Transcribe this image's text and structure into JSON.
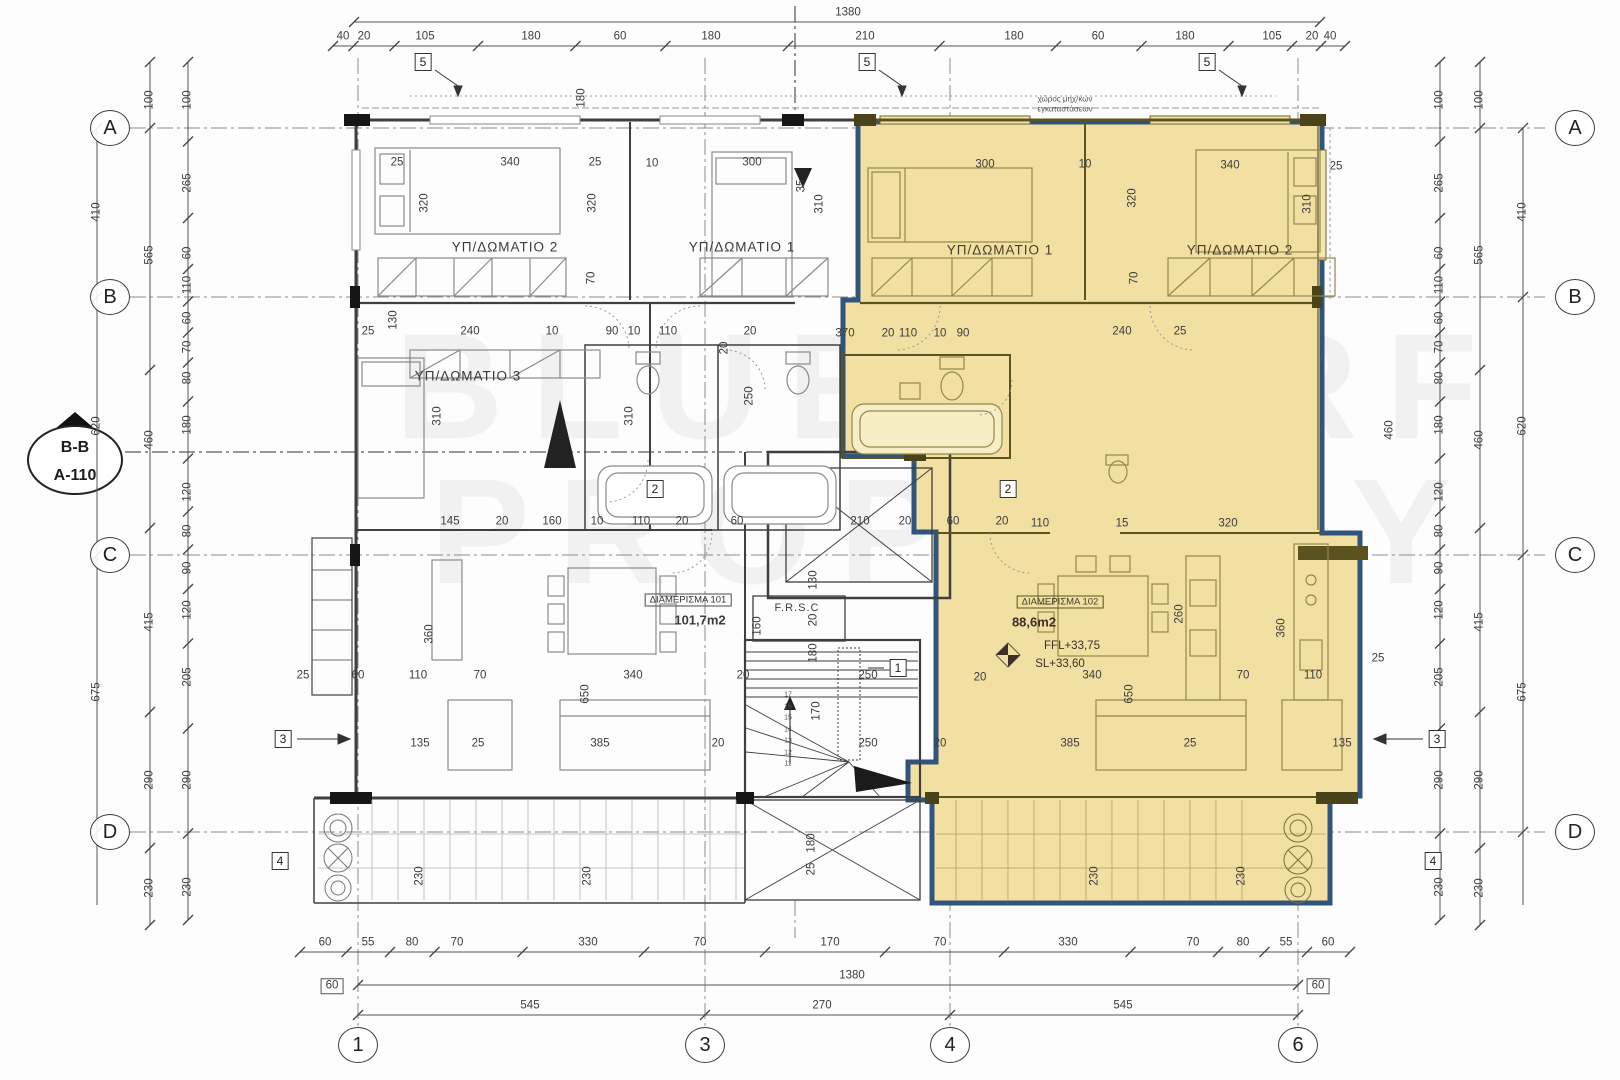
{
  "title": "Floor plan",
  "watermark": {
    "line1": "BLUE SURF",
    "line2": "PROPERTY"
  },
  "colors": {
    "highlight": "#f2dfa2",
    "highlight_border": "#31547c",
    "wall_dark": "#3f3f3f",
    "wall_olive": "#5c541f",
    "grid_line": "#8a8a8a",
    "dim_text": "#3d3d3d"
  },
  "section_marker": {
    "top": "B-B",
    "bottom": "A-110"
  },
  "notes": {
    "top_center_1": "χώρος μηχ/κων",
    "top_center_2": "εγκαταστάσεων",
    "frsc": "F.R.S.C"
  },
  "apartments": [
    {
      "name": "ΔΙΑΜΕΡΙΣΜΑ 101",
      "area": "101,7m2"
    },
    {
      "name": "ΔΙΑΜΕΡΙΣΜΑ 102",
      "area": "88,6m2",
      "ffl": "FFL+33,75",
      "sl": "SL+33,60"
    }
  ],
  "rooms": {
    "left_bed2": "ΥΠ/ΔΩΜΑΤΙΟ 2",
    "left_bed1": "ΥΠ/ΔΩΜΑΤΙΟ 1",
    "left_bed3": "ΥΠ/ΔΩΜΑΤΙΟ 3",
    "right_bed1": "ΥΠ/ΔΩΜΑΤΙΟ 1",
    "right_bed2": "ΥΠ/ΔΩΜΑΤΙΟ 2"
  },
  "grid": {
    "bubble_left_x": 110,
    "bubble_right_x": 1575,
    "bubble_bottom_y": 1045,
    "rows": [
      {
        "label": "A",
        "y": 128
      },
      {
        "label": "B",
        "y": 297
      },
      {
        "label": "C",
        "y": 555
      },
      {
        "label": "D",
        "y": 832
      }
    ],
    "cols": [
      {
        "label": "1",
        "x": 358
      },
      {
        "label": "3",
        "x": 705
      },
      {
        "label": "4",
        "x": 950
      },
      {
        "label": "6",
        "x": 1298
      }
    ]
  },
  "detail_markers": [
    {
      "label": "5",
      "x": 423,
      "y": 62
    },
    {
      "label": "5",
      "x": 867,
      "y": 62
    },
    {
      "label": "5",
      "x": 1207,
      "y": 62
    },
    {
      "label": "2",
      "x": 655,
      "y": 489
    },
    {
      "label": "2",
      "x": 1008,
      "y": 489
    },
    {
      "label": "1",
      "x": 898,
      "y": 668
    },
    {
      "label": "3",
      "x": 283,
      "y": 739
    },
    {
      "label": "3",
      "x": 1437,
      "y": 739
    },
    {
      "label": "4",
      "x": 280,
      "y": 861
    },
    {
      "label": "4",
      "x": 1433,
      "y": 861
    }
  ],
  "stair": {
    "steps": [
      "17",
      "16",
      "15",
      "14",
      "13",
      "12",
      "11"
    ],
    "x": 788,
    "y0": 695,
    "dy": 11.5
  },
  "dims": {
    "rows": [
      {
        "y": 22,
        "x1": 354,
        "x2": 1320,
        "ticks": [
          354,
          1320
        ],
        "labels": [
          [
            "1380",
            848
          ]
        ]
      },
      {
        "y": 46,
        "x1": 333,
        "x2": 1345,
        "labels": [
          [
            "40",
            343
          ],
          [
            "20",
            364
          ],
          [
            "105",
            425
          ],
          [
            "180",
            531
          ],
          [
            "60",
            620
          ],
          [
            "180",
            711
          ],
          [
            "210",
            865
          ],
          [
            "180",
            1014
          ],
          [
            "60",
            1098
          ],
          [
            "180",
            1185
          ],
          [
            "105",
            1272
          ],
          [
            "20",
            1312
          ],
          [
            "40",
            1330
          ]
        ]
      },
      {
        "y": 952,
        "x1": 300,
        "x2": 1350,
        "labels": [
          [
            "60",
            325
          ],
          [
            "55",
            368
          ],
          [
            "80",
            412
          ],
          [
            "70",
            457
          ],
          [
            "330",
            588
          ],
          [
            "70",
            700
          ],
          [
            "170",
            830
          ],
          [
            "70",
            940
          ],
          [
            "330",
            1068
          ],
          [
            "70",
            1193
          ],
          [
            "80",
            1243
          ],
          [
            "55",
            1286
          ],
          [
            "60",
            1328
          ]
        ]
      },
      {
        "y": 985,
        "x1": 358,
        "x2": 1298,
        "ticks": [
          358,
          1298
        ],
        "labels": [
          [
            "1380",
            852
          ]
        ]
      },
      {
        "y": 1015,
        "x1": 358,
        "x2": 1298,
        "ticks": [
          358,
          705,
          950,
          1298
        ],
        "labels": [
          [
            "545",
            530
          ],
          [
            "270",
            822
          ],
          [
            "545",
            1123
          ]
        ]
      }
    ],
    "cols": [
      {
        "x": 97,
        "y1": 128,
        "y2": 905,
        "ticks": [
          128,
          297,
          555,
          832
        ],
        "labels": [
          [
            "410",
            212
          ],
          [
            "620",
            426
          ],
          [
            "675",
            692
          ]
        ]
      },
      {
        "x": 150,
        "y1": 62,
        "y2": 925,
        "ticks": [
          62,
          128,
          370,
          528,
          712,
          848,
          925
        ],
        "labels": [
          [
            "100",
            100
          ],
          [
            "565",
            255
          ],
          [
            "460",
            440
          ],
          [
            "415",
            622
          ],
          [
            "290",
            780
          ],
          [
            "230",
            888
          ]
        ]
      },
      {
        "x": 188,
        "y1": 62,
        "y2": 920,
        "labels": [
          [
            "100",
            100
          ],
          [
            "265",
            183
          ],
          [
            "60",
            253
          ],
          [
            "110",
            285
          ],
          [
            "60",
            318
          ],
          [
            "70",
            347
          ],
          [
            "80",
            378
          ],
          [
            "180",
            425
          ],
          [
            "120",
            492
          ],
          [
            "80",
            531
          ],
          [
            "90",
            568
          ],
          [
            "120",
            610
          ],
          [
            "205",
            677
          ],
          [
            "290",
            780
          ],
          [
            "230",
            887
          ]
        ]
      },
      {
        "x": 1523,
        "y1": 128,
        "y2": 905,
        "ticks": [
          128,
          297,
          555,
          832
        ],
        "labels": [
          [
            "410",
            212
          ],
          [
            "620",
            426
          ],
          [
            "675",
            692
          ]
        ]
      },
      {
        "x": 1480,
        "y1": 62,
        "y2": 925,
        "ticks": [
          62,
          128,
          370,
          528,
          712,
          848,
          925
        ],
        "labels": [
          [
            "100",
            100
          ],
          [
            "565",
            255
          ],
          [
            "460",
            440
          ],
          [
            "415",
            622
          ],
          [
            "290",
            780
          ],
          [
            "230",
            888
          ]
        ]
      },
      {
        "x": 1440,
        "y1": 62,
        "y2": 920,
        "labels": [
          [
            "100",
            100
          ],
          [
            "265",
            183
          ],
          [
            "60",
            253
          ],
          [
            "110",
            285
          ],
          [
            "60",
            318
          ],
          [
            "70",
            347
          ],
          [
            "80",
            378
          ],
          [
            "180",
            425
          ],
          [
            "120",
            492
          ],
          [
            "80",
            531
          ],
          [
            "90",
            568
          ],
          [
            "120",
            610
          ],
          [
            "205",
            677
          ],
          [
            "290",
            780
          ],
          [
            "230",
            887
          ]
        ]
      }
    ],
    "free": [
      [
        "25",
        397,
        163,
        0
      ],
      [
        "340",
        510,
        163,
        0
      ],
      [
        "25",
        595,
        163,
        0
      ],
      [
        "10",
        652,
        164,
        0
      ],
      [
        "300",
        752,
        163,
        0
      ],
      [
        "35",
        802,
        186,
        1
      ],
      [
        "300",
        985,
        165,
        0
      ],
      [
        "10",
        1085,
        165,
        0
      ],
      [
        "340",
        1230,
        166,
        0
      ],
      [
        "25",
        1336,
        167,
        0
      ],
      [
        "320",
        425,
        203,
        1
      ],
      [
        "320",
        593,
        203,
        1
      ],
      [
        "310",
        820,
        204,
        1
      ],
      [
        "320",
        1133,
        198,
        1
      ],
      [
        "310",
        1308,
        204,
        1
      ],
      [
        "180",
        582,
        98,
        1
      ],
      [
        "70",
        592,
        278,
        1
      ],
      [
        "70",
        1135,
        278,
        1
      ],
      [
        "25",
        368,
        332,
        0
      ],
      [
        "240",
        470,
        332,
        0
      ],
      [
        "10",
        552,
        332,
        0
      ],
      [
        "90",
        612,
        332,
        0
      ],
      [
        "10",
        634,
        332,
        0
      ],
      [
        "110",
        668,
        332,
        0
      ],
      [
        "20",
        750,
        332,
        0
      ],
      [
        "130",
        394,
        320,
        1
      ],
      [
        "370",
        845,
        334,
        0
      ],
      [
        "20",
        888,
        334,
        0
      ],
      [
        "110",
        908,
        334,
        0
      ],
      [
        "10",
        940,
        334,
        0
      ],
      [
        "90",
        963,
        334,
        0
      ],
      [
        "240",
        1122,
        332,
        0
      ],
      [
        "25",
        1180,
        332,
        0
      ],
      [
        "250",
        750,
        396,
        1
      ],
      [
        "20",
        725,
        348,
        1
      ],
      [
        "310",
        438,
        416,
        1
      ],
      [
        "310",
        630,
        416,
        1
      ],
      [
        "460",
        1390,
        430,
        1
      ],
      [
        "145",
        450,
        522,
        0
      ],
      [
        "20",
        502,
        522,
        0
      ],
      [
        "160",
        552,
        522,
        0
      ],
      [
        "10",
        597,
        522,
        0
      ],
      [
        "110",
        641,
        522,
        0
      ],
      [
        "20",
        682,
        522,
        0
      ],
      [
        "60",
        737,
        522,
        0
      ],
      [
        "210",
        860,
        522,
        0
      ],
      [
        "20",
        905,
        522,
        0
      ],
      [
        "60",
        953,
        522,
        0
      ],
      [
        "20",
        1002,
        522,
        0
      ],
      [
        "110",
        1040,
        524,
        0
      ],
      [
        "15",
        1122,
        524,
        0
      ],
      [
        "320",
        1228,
        524,
        0
      ],
      [
        "130",
        814,
        580,
        1
      ],
      [
        "20",
        814,
        620,
        1
      ],
      [
        "180",
        814,
        653,
        1
      ],
      [
        "160",
        758,
        626,
        1
      ],
      [
        "360",
        430,
        634,
        1
      ],
      [
        "25",
        303,
        676,
        0
      ],
      [
        "60",
        358,
        676,
        0
      ],
      [
        "110",
        418,
        676,
        0
      ],
      [
        "70",
        480,
        676,
        0
      ],
      [
        "340",
        633,
        676,
        0
      ],
      [
        "20",
        743,
        676,
        0
      ],
      [
        "650",
        586,
        694,
        1
      ],
      [
        "650",
        1130,
        694,
        1
      ],
      [
        "340",
        1092,
        676,
        0
      ],
      [
        "70",
        1243,
        676,
        0
      ],
      [
        "110",
        1313,
        676,
        0
      ],
      [
        "25",
        1378,
        659,
        0
      ],
      [
        "20",
        980,
        678,
        0
      ],
      [
        "260",
        1180,
        614,
        1
      ],
      [
        "360",
        1282,
        628,
        1
      ],
      [
        "135",
        420,
        744,
        0
      ],
      [
        "25",
        478,
        744,
        0
      ],
      [
        "385",
        600,
        744,
        0
      ],
      [
        "20",
        718,
        744,
        0
      ],
      [
        "20",
        940,
        744,
        0
      ],
      [
        "385",
        1070,
        744,
        0
      ],
      [
        "25",
        1190,
        744,
        0
      ],
      [
        "135",
        1342,
        744,
        0
      ],
      [
        "250",
        868,
        676,
        0
      ],
      [
        "250",
        868,
        744,
        0
      ],
      [
        "170",
        817,
        711,
        1
      ],
      [
        "180",
        812,
        843,
        1
      ],
      [
        "25",
        812,
        869,
        1
      ],
      [
        "230",
        420,
        876,
        1
      ],
      [
        "230",
        588,
        876,
        1
      ],
      [
        "230",
        1095,
        876,
        1
      ],
      [
        "230",
        1242,
        876,
        1
      ],
      [
        "60",
        332,
        986,
        0,
        1
      ],
      [
        "60",
        1318,
        986,
        0,
        1
      ]
    ]
  }
}
